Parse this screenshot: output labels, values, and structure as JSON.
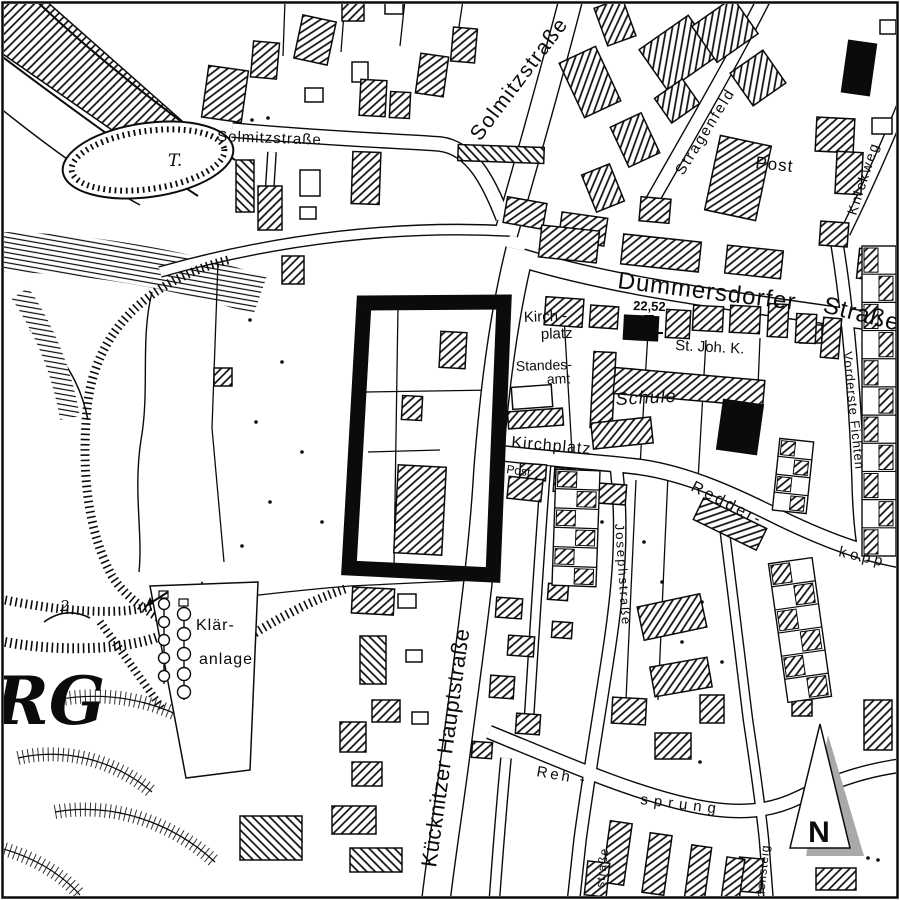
{
  "map": {
    "type": "scanned-cadastral-city-map",
    "colors": {
      "ink": "#0b0b0b",
      "paper": "#ffffff",
      "shadow": "#a9a9a9"
    },
    "labels": {
      "solmitz_horizontal": "Solmitzstraße",
      "solmitz_diagonal": "Solmitzstraße",
      "stragenfeld": "Stragenfeld",
      "knickweg": "Knickweg",
      "post_top": "Post",
      "dummersdorfer_1": "Dummersdorfer",
      "dummersdorfer_2": "Straße",
      "elevation_point": "22,52",
      "church": "St. Joh. K.",
      "school": "Schule",
      "kirchplatz_square_1": "Kirch -",
      "kirchplatz_square_2": "platz",
      "registry_1": "Standes-",
      "registry_2": "amt",
      "kirchplatz_street": "Kirchplatz",
      "post_small": "Post",
      "redderkoppel_1": "Redder-",
      "redderkoppel_2": "kopp",
      "vorderste_fichten": "Vorderste Fichten",
      "josephstrasse": "Josephstraße",
      "hauptstrasse": "Kücknitzer Hauptstraße",
      "rehsprung_1": "Reh -",
      "rehsprung_2": "sprung",
      "densteig": "densteig",
      "strasse_fragment": "straße",
      "sewage_1": "Klär-",
      "sewage_2": "anlage",
      "rg_fragment": "RG",
      "pond": "T.",
      "contour_number": "2",
      "north": "N"
    }
  }
}
